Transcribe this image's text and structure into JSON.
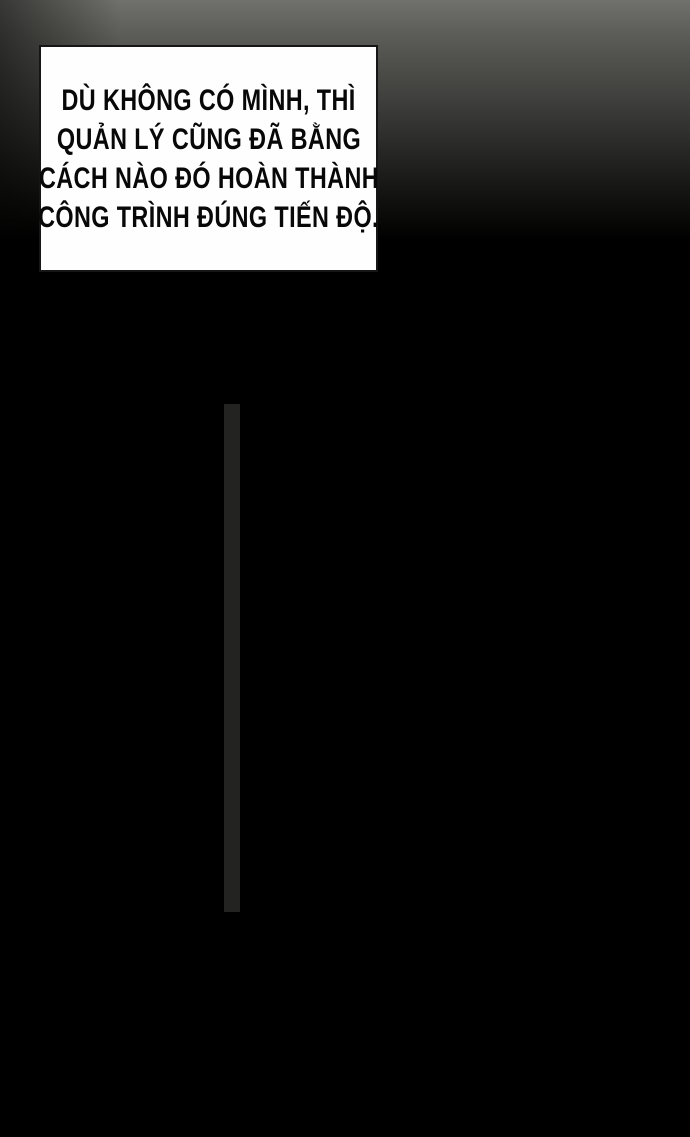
{
  "bubble": {
    "lines": [
      "DÙ KHÔNG CÓ MÌNH, THÌ",
      "QUẢN LÝ CŨNG ĐÃ BẰNG",
      "CÁCH NÀO ĐÓ HOÀN THÀNH",
      "CÔNG TRÌNH ĐÚNG TIẾN ĐỘ."
    ]
  },
  "palette": {
    "background": "#000000",
    "top_gradient": "#70706c",
    "bubble_bg": "#fefefe",
    "bubble_border": "#161616",
    "ink": "#080808",
    "facade_white": "#f1f1ef",
    "pane_gray": "#8d8d8b",
    "frame_dark": "#1b1b19",
    "tower_body": "#a9a9a7",
    "door_gray": "#969694"
  },
  "building": {
    "grid_band": {
      "sections": 6,
      "cols": 4,
      "rows": 4
    },
    "mid_band": {
      "sections": [
        "full",
        "split",
        "split",
        "split",
        "full"
      ],
      "widths": [
        36,
        48,
        60,
        53,
        43
      ]
    },
    "lower_band": {
      "white_panes": 6,
      "small_squares": 12,
      "tabs": 4
    },
    "tower_panels": [
      "tall",
      "short",
      "short",
      "tall",
      "short",
      "tall",
      "short",
      "short",
      "tall",
      "short",
      "tall"
    ],
    "storefront": {
      "leaves": 6,
      "finials": 4
    },
    "frieze_drops": 4
  }
}
